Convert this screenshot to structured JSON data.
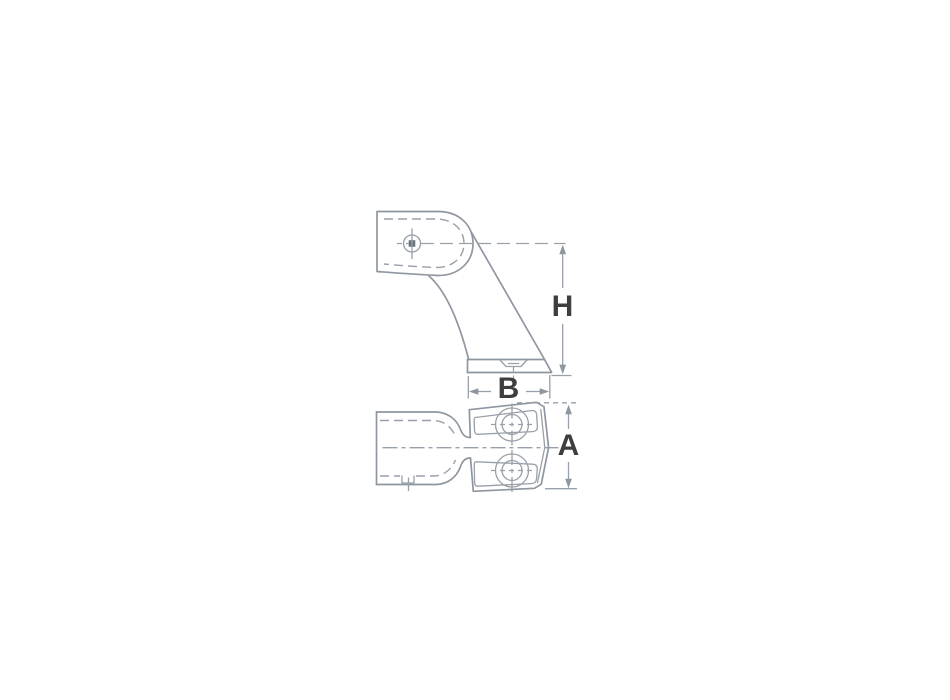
{
  "drawing": {
    "labels": {
      "height": "H",
      "width": "B",
      "plate": "A"
    },
    "colors": {
      "background": "#ffffff",
      "line": "#8e96a0",
      "label_text": "#3d3e40"
    }
  }
}
